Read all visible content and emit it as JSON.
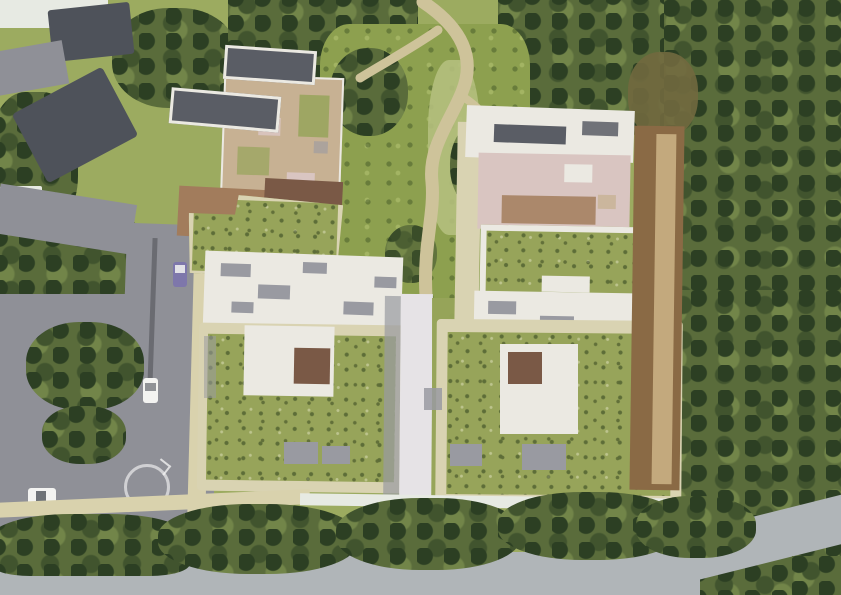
{
  "scene": {
    "description": "Aerial architectural rendering of a residential complex with extensive green roofs, rooftop terraces and solar panels, arranged around a central landscaped courtyard with a winding footpath, bordered by streets with cars, sidewalks, a faint roundabout marking, and dense surrounding trees"
  },
  "palette": {
    "lawn_light": "#9cab60",
    "lawn_pale": "#b4bf7d",
    "courtyard_green": "#8da04f",
    "forest_mid": "#5a6c3b",
    "forest_dark": "#41542e",
    "tree_dark": "#2c3f23",
    "brush_brown": "#71693f",
    "road_gray": "#8f9097",
    "road_light": "#b0b5b8",
    "median_dark": "#606268",
    "sidewalk": "#d9d2ad",
    "path_beige": "#cec39a",
    "walkway_pale": "#e6e3e6",
    "parapet_beige": "#d9d3b2",
    "green_roof": "#97a45a",
    "green_roof_dot": "#5d6d38",
    "white_roof": "#ebe9e2",
    "equipment_gray": "#999aa1",
    "slate_pv": "#5a5d65",
    "slate_roof": "#4e525a",
    "terrace_pink": "#d9c5c1",
    "terrace_tan": "#c7b193",
    "roof_brown_dark": "#7a5946",
    "roof_brown_light": "#a27c5c",
    "timber_brown": "#8a6a45",
    "timber_light": "#c3a97d",
    "car_white": "#f3f3f1",
    "car_purple": "#7e77ab",
    "pale_ground": "#e7eae3",
    "marking_white": "#f2f2f2"
  },
  "regions": [
    {
      "name": "surrounding-forest",
      "color": "#5a6c3b"
    },
    {
      "name": "streets",
      "color": "#8f9097"
    },
    {
      "name": "green-roofs",
      "color": "#97a45a"
    },
    {
      "name": "courtyard-garden",
      "color": "#8da04f"
    },
    {
      "name": "rooftop-terraces",
      "color": "#d9c5c1"
    },
    {
      "name": "timber-facade-edge",
      "color": "#8a6a45"
    },
    {
      "name": "solar-panels",
      "color": "#5a5d65"
    }
  ]
}
